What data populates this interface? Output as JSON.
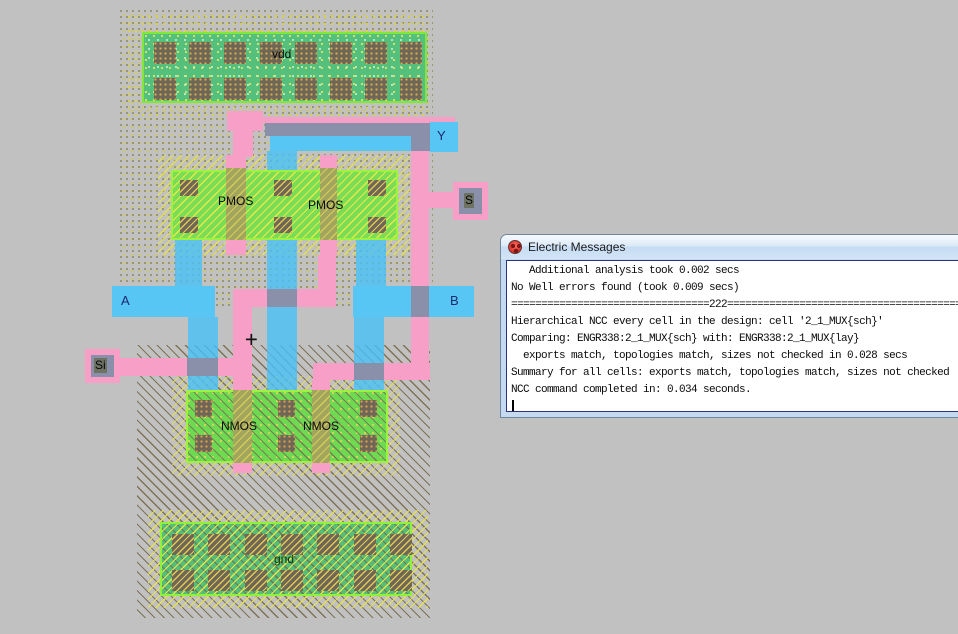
{
  "layout": {
    "power_rail_label": "vdd",
    "ground_rail_label": "gnd",
    "pmos_labels": [
      "PMOS",
      "PMOS"
    ],
    "nmos_labels": [
      "NMOS",
      "NMOS"
    ],
    "port_labels": {
      "a": "A",
      "b": "B",
      "y": "Y",
      "s": "S",
      "si": "Si"
    },
    "cursor_glyph": "+"
  },
  "window": {
    "title": "Electric Messages",
    "lines": [
      "   Additional analysis took 0.002 secs",
      "No Well errors found (took 0.009 secs)",
      "=================================222============================================================",
      "Hierarchical NCC every cell in the design: cell '2_1_MUX{sch}'",
      "Comparing: ENGR338:2_1_MUX{sch} with: ENGR338:2_1_MUX{lay}",
      "  exports match, topologies match, sizes not checked in 0.028 secs",
      "Summary for all cells: exports match, topologies match, sizes not checked",
      "NCC command completed in: 0.034 seconds."
    ]
  },
  "colors": {
    "canvas": "#c1c1c1",
    "metal1": "#58c6f4",
    "poly": "#f79fc6",
    "metal_overlap": "#8b90aa",
    "mos_active": "#79dd55",
    "rail_active": "#54c07c",
    "contact": "#6e6757",
    "select_hatch": "#e4df4f",
    "well_hatch": "#7e7257",
    "port_label_navy": "#1c2a6e",
    "window_frame": "#c5d9f0",
    "console_text": "#0a0a0a"
  }
}
